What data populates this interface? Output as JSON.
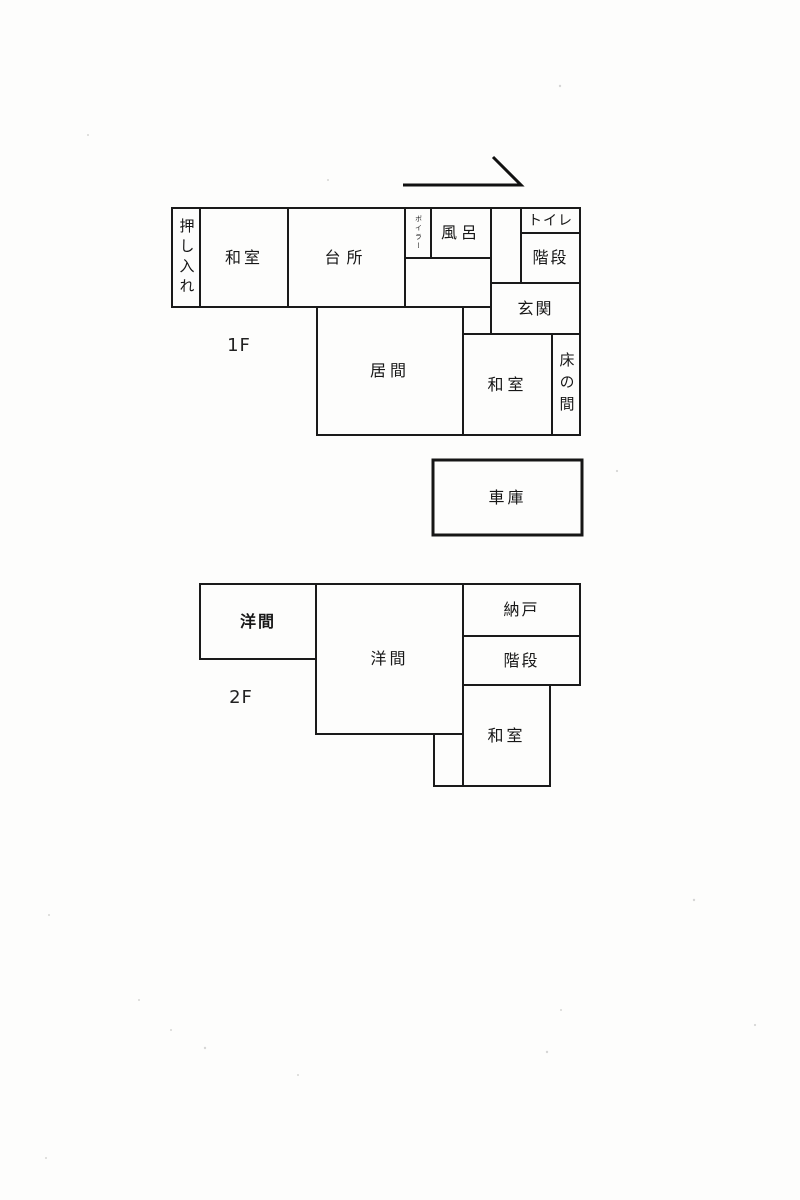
{
  "floor1": {
    "label": "1F",
    "rooms": {
      "oshiire": "押し入れ",
      "washitsu_left": "和室",
      "daidokoro": "台所",
      "boiler": "ボイラー",
      "furo": "風呂",
      "toilet": "トイレ",
      "kaidan": "階段",
      "genkan": "玄関",
      "ima": "居間",
      "washitsu_right": "和室",
      "tokonoma": "床の間"
    }
  },
  "garage": {
    "label": "車庫"
  },
  "floor2": {
    "label": "2F",
    "rooms": {
      "youma_left": "洋間",
      "youma_center": "洋間",
      "nando": "納戸",
      "kaidan": "階段",
      "washitsu": "和室"
    }
  },
  "colors": {
    "line": "#1a1a1a",
    "paper": "#fdfdfc"
  }
}
